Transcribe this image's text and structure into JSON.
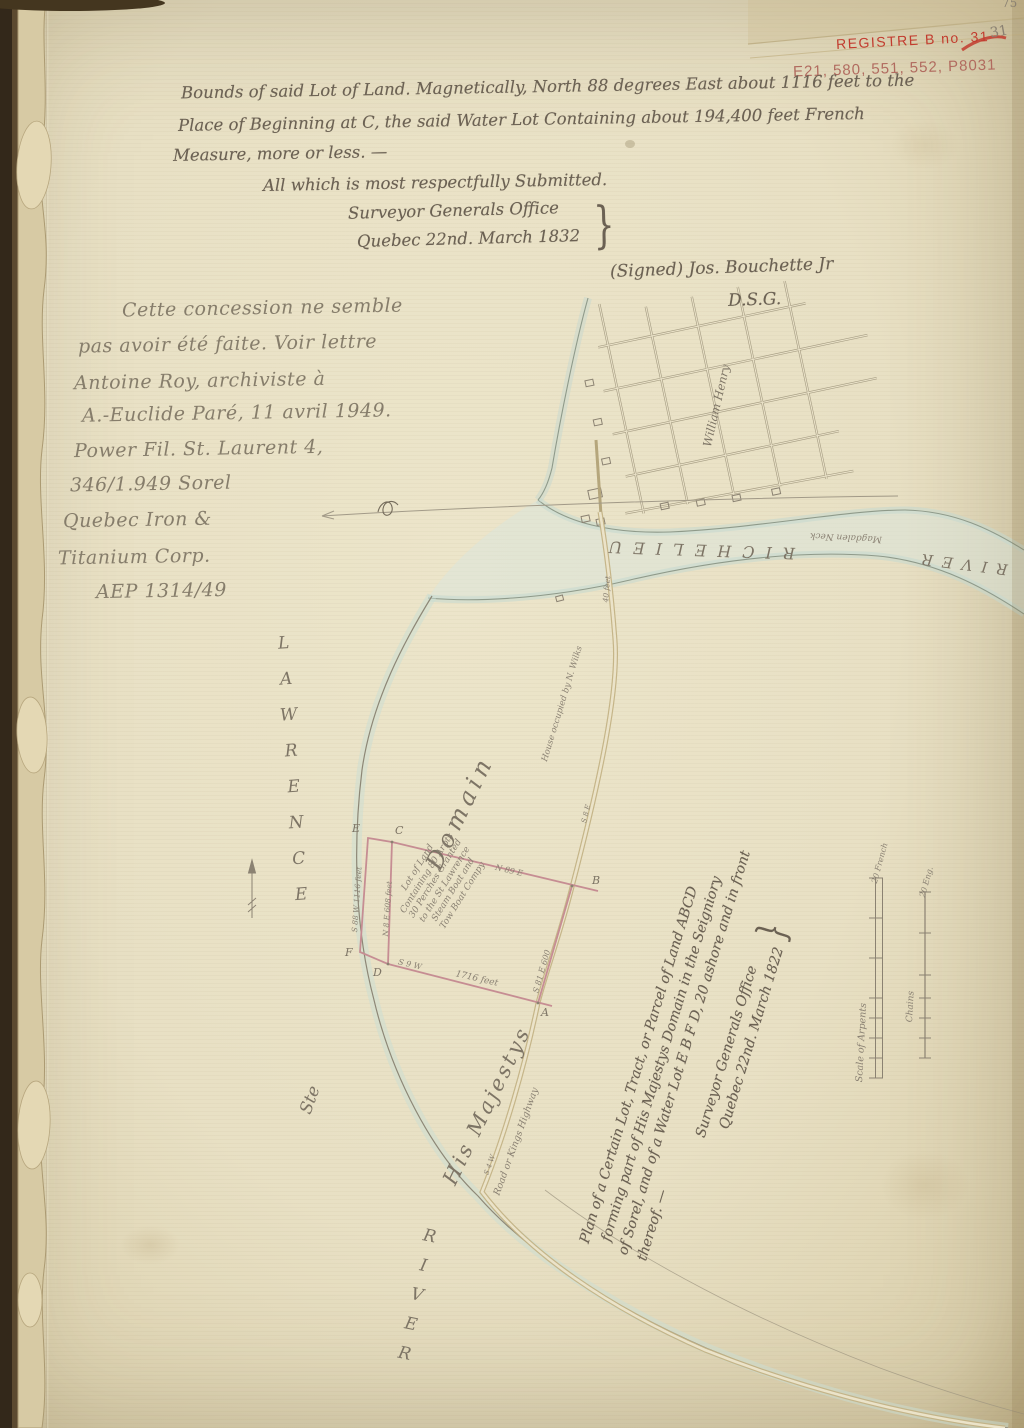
{
  "annotations": {
    "stamp": "REGISTRE B no. 31",
    "refs": "E21, 580, 551, 552, P8031",
    "page_number": "31",
    "page_number_top": "75"
  },
  "report": {
    "line1": "Bounds of said Lot of Land. Magnetically, North 88 degrees East about 1116 feet to the",
    "line2": "Place of Beginning at C, the said Water Lot Containing about 194,400 feet French",
    "line3": "Measure, more or less. —",
    "line4": "All which is most respectfully Submitted.",
    "office": "Surveyor Generals Office",
    "dateline": "Quebec 22nd. March 1832",
    "brace": "}",
    "signed": "(Signed) Jos. Bouchette Jr",
    "dsg": "D.S.G."
  },
  "pencil_note": {
    "lines": [
      "Cette concession ne semble",
      "pas avoir été faite. Voir lettre",
      "Antoine Roy, archiviste à",
      "A.-Euclide Paré, 11 avril 1949.",
      "Power Fil. St. Laurent 4,",
      "346/1.949   Sorel",
      "Quebec Iron &",
      "Titanium Corp.",
      "AEP 1314/49"
    ]
  },
  "map": {
    "town": "William Henry",
    "richelieu_word": "RICHELIEU",
    "richelieu_river_word": "RIVER",
    "magdalen_neck": "Magdalen Neck",
    "st_word": "Ste",
    "lawrence_word": "LAWRENCE",
    "river_word": "RIVER",
    "domain": "Domain",
    "his_majestys": "His Majestys",
    "house_label": "House occupied by N. Wilks",
    "bridge_label": "40 feet",
    "lot_lines": [
      "Lot of Land",
      "Containing 80 Arpts",
      "30 Perches Granted",
      "to the St Lawrence",
      "Steam Boat and",
      "Tow Boat Compy"
    ],
    "corners": {
      "a": "A",
      "b": "B",
      "c": "C",
      "d": "D",
      "e": "E",
      "f": "F"
    },
    "bearings": {
      "strip_outer": "S 88 W 1116 feet",
      "strip_inner": "N 8 E 608 feet",
      "top_edge": "N 89 E",
      "bottom_bearing": "S 9 W",
      "bottom_length": "1716 feet",
      "near_a": "S 81 E 600",
      "road_upper": "S 8 E",
      "road_lower": "S 4 W"
    },
    "road_label": "Road or Kings Highway",
    "plan": {
      "lines": [
        "Plan of a Certain Lot, Tract, or Parcel of Land ABCD",
        "forming part of His Majestys Domain in the Seigniory",
        "of Sorel, and of a Water Lot E B F D, 20 ashore and in front",
        "thereof. —",
        "Surveyor Generals Office",
        "Quebec 22nd. March 1822"
      ],
      "brace": "}"
    },
    "scales": {
      "arpents_label": "Scale of Arpents",
      "arpents_end": "20 French",
      "chains_label": "Chains",
      "chains_end": "20 Eng."
    }
  }
}
